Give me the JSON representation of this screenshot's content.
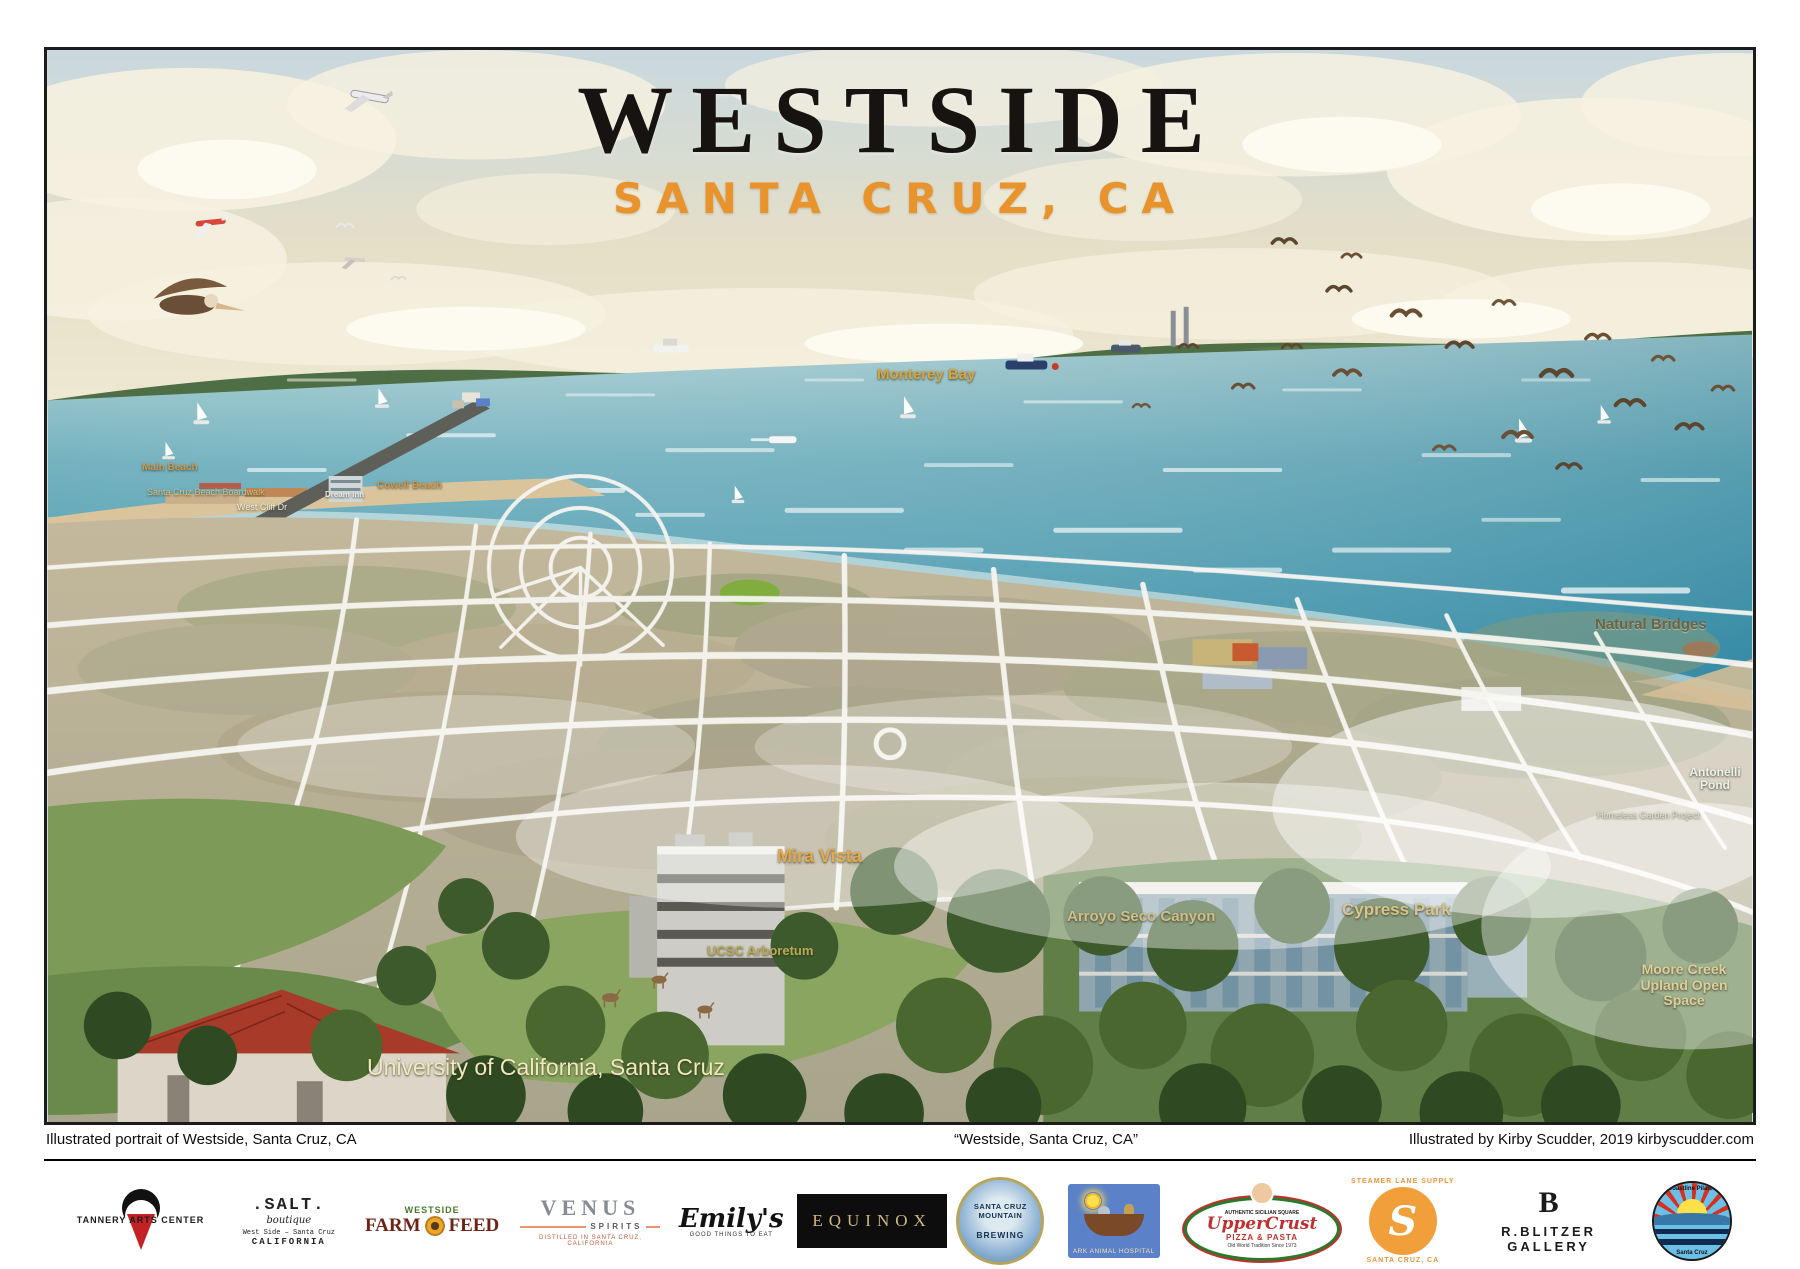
{
  "poster": {
    "title": "WESTSIDE",
    "subtitle": "SANTA CRUZ, CA",
    "colors": {
      "subtitle_orange": "#e8932b",
      "sea": "#4397ae",
      "label_orange": "#e0a84a"
    }
  },
  "map": {
    "labels": {
      "monterey_bay": "Monterey Bay",
      "mira_vista": "Mira Vista",
      "arroyo_seco": "Arroyo Seco Canyon",
      "cypress_park": "Cypress Park",
      "ucsc_arboretum": "UCSC Arboretum",
      "moore_creek": "Moore Creek Upland Open Space",
      "natural_bridges": "Natural Bridges",
      "antonelli_pond": "Antonelli Pond",
      "university": "University of California, Santa Cruz",
      "main_beach": "Main Beach",
      "boardwalk": "Santa Cruz Beach Boardwalk",
      "cowell_beach": "Cowell Beach",
      "dream_inn": "Dream Inn",
      "west_cliff": "West Cliff Dr",
      "homeless_garden": "Homeless Garden Project"
    }
  },
  "caption": {
    "left": "Illustrated portrait of Westside, Santa Cruz, CA",
    "center": "“Westside, Santa Cruz, CA”",
    "right": "Illustrated by Kirby Scudder, 2019  kirbyscudder.com"
  },
  "logos": {
    "tannery": {
      "line": "TANNERY ARTS CENTER"
    },
    "salt": {
      "name": ".SALT.",
      "sub1": "boutique",
      "sub2": "West Side – Santa Cruz",
      "sub3": "CALIFORNIA"
    },
    "farmfeed": {
      "top": "WESTSIDE",
      "left": "FARM",
      "right": "FEED"
    },
    "venus": {
      "name": "VENUS",
      "sub": "SPIRITS",
      "tag": "DISTILLED IN SANTA CRUZ, CALIFORNIA"
    },
    "emilys": {
      "name": "Emily's",
      "tag": "GOOD THINGS TO EAT"
    },
    "equinox": {
      "name": "EQUINOX"
    },
    "scmb": {
      "l1": "SANTA CRUZ",
      "l2": "MOUNTAIN",
      "l3": "BREWING"
    },
    "ark": {
      "name": "ARK ANIMAL HOSPITAL"
    },
    "uppercrust": {
      "top": "AUTHENTIC SICILIAN SQUARE",
      "name": "UpperCrust",
      "sub": "PIZZA & PASTA",
      "tag": "Old World Tradition Since 1973"
    },
    "steamer": {
      "arc_top": "STEAMER LANE SUPPLY",
      "monogram": "S",
      "arc_bottom": "SANTA CRUZ, CA"
    },
    "blitzer": {
      "monogram": "B",
      "name": "R.BLITZER GALLERY"
    },
    "pilates": {
      "arc_top": "Coastline Pilates",
      "arc_bottom": "Santa Cruz"
    }
  }
}
